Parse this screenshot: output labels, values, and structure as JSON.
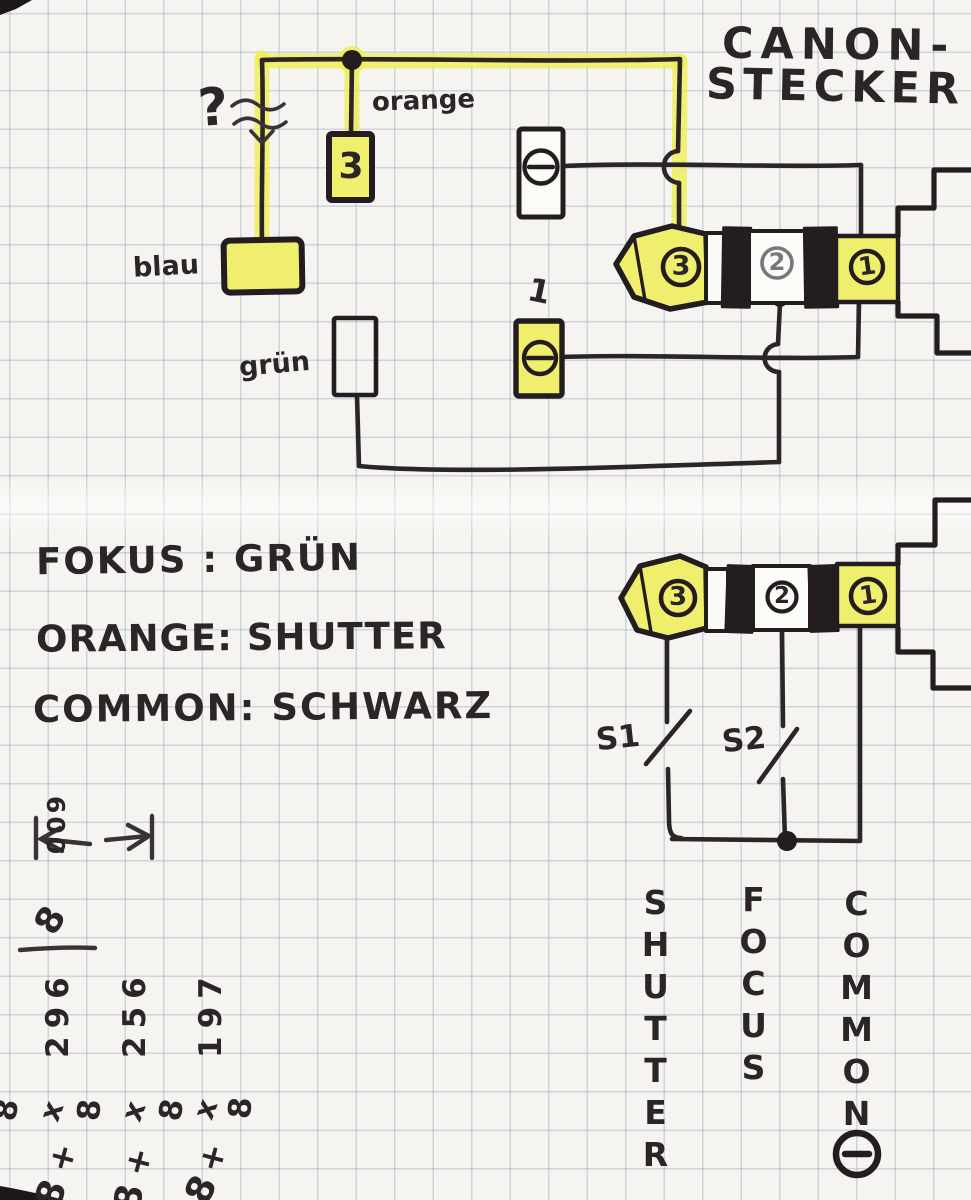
{
  "title": {
    "line1": "CANON-",
    "line2": "STECKER"
  },
  "labels": {
    "question": "?",
    "orange": "orange",
    "blau": "blau",
    "gruen": "grün",
    "terminal_one": "1"
  },
  "boxes": {
    "orange_pin": "3"
  },
  "plugs": {
    "upper": {
      "pins": [
        "3",
        "2",
        "1"
      ]
    },
    "lower": {
      "pins": [
        "3",
        "2",
        "1"
      ]
    }
  },
  "notes": {
    "line1": "FOKUS : GRÜN",
    "line2": "ORANGE: SHUTTER",
    "line3": "COMMON: SCHWARZ"
  },
  "switches": {
    "s1": "S1",
    "s2": "S2"
  },
  "signals": {
    "shutter": "SHUTTER",
    "focus": "FOCUS",
    "common": "COMMON"
  },
  "scratchpad": {
    "dimension": "600",
    "eight": "8",
    "col1": "296",
    "col2": "256",
    "col3": "197",
    "calc": [
      "8",
      "x",
      "8",
      "x",
      "8",
      "x",
      "8"
    ],
    "plus": "+",
    "plus_digit": "8"
  },
  "icons": {
    "minus_terminal": "−"
  },
  "colors": {
    "highlighter": "#f0ef6d",
    "pen": "#2c2528",
    "pencil": "#7b757d",
    "paper": "#f5f4f0",
    "grid": "#96a3c0"
  }
}
